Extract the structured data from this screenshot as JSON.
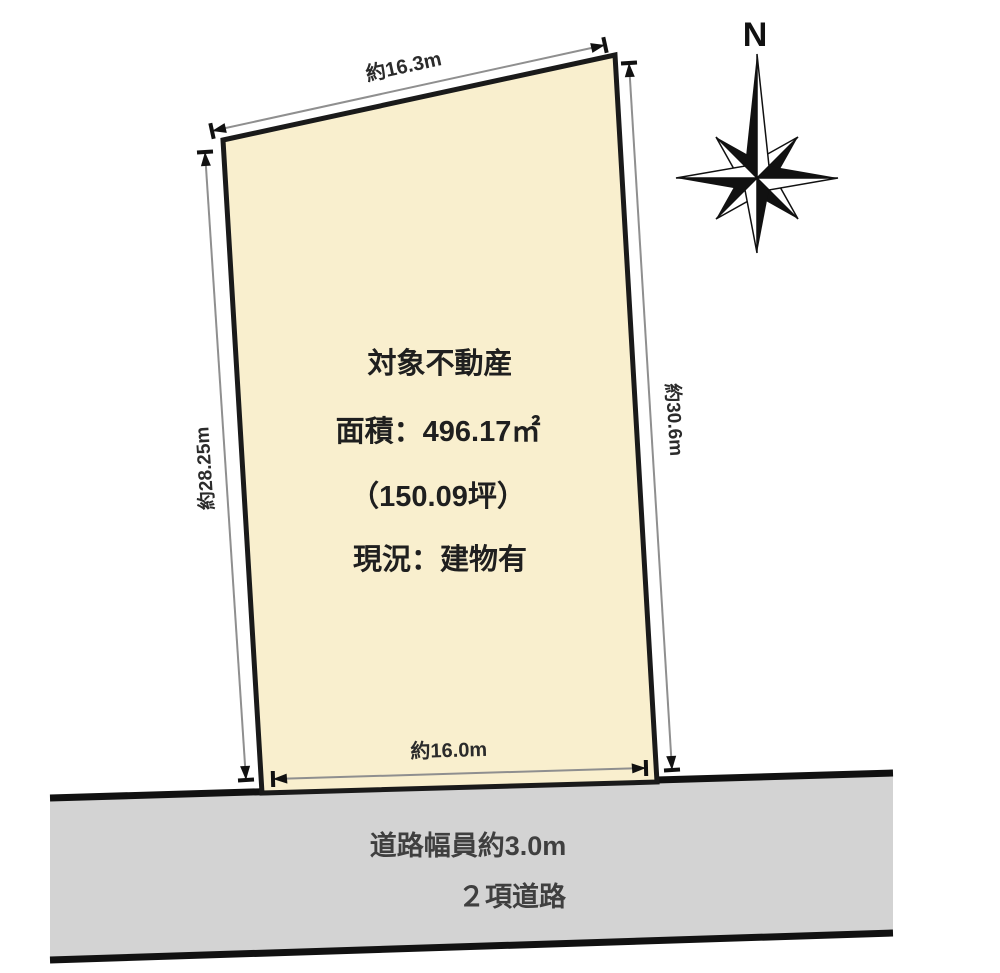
{
  "parcel": {
    "title": "対象不動産",
    "area_line": "面積：496.17㎡",
    "tsubo_line": "（150.09坪）",
    "status_line": "現況：建物有",
    "fill_color": "#F9EFCE"
  },
  "dimensions": {
    "top": "約16.3m",
    "left": "約28.25m",
    "right": "約30.6m",
    "bottom": "約16.0m"
  },
  "road": {
    "width_label": "道路幅員約3.0m",
    "type_label": "２項道路",
    "fill_color": "#D3D3D3"
  },
  "compass": {
    "north_label": "N"
  }
}
